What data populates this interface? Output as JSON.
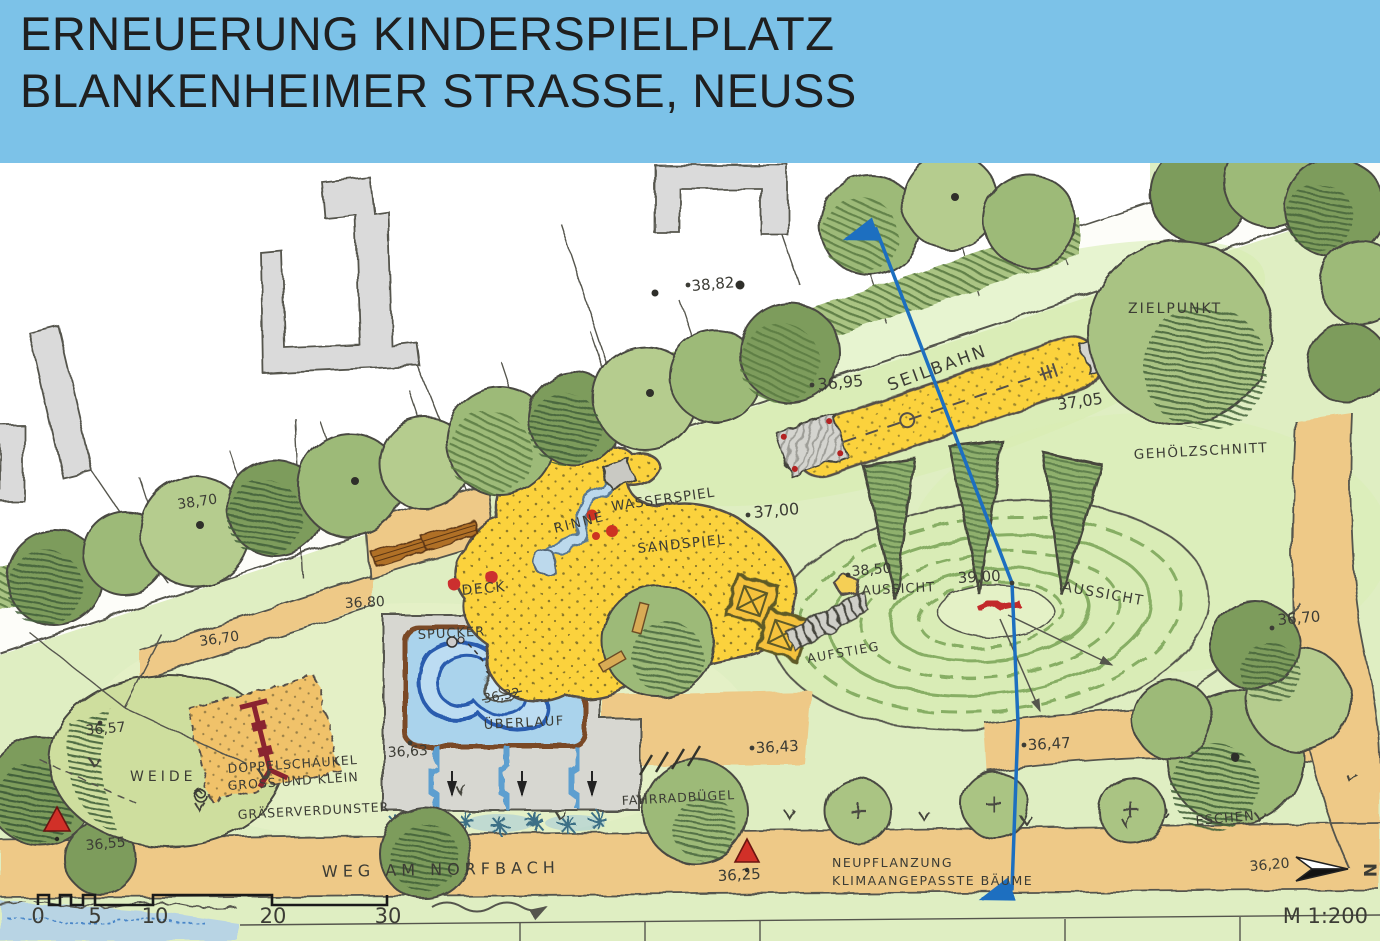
{
  "header": {
    "title_line1": "ERNEUERUNG KINDERSPIELPLATZ",
    "title_line2": "BLANKENHEIMER STRASSE, NEUSS"
  },
  "plan": {
    "labels": {
      "zielpunkt": "ZIELPUNKT",
      "seilbahn": "SEILBAHN",
      "gehoelzschnitt": "GEHÖLZSCHNITT",
      "wasserspiel": "WASSERSPIEL",
      "rinne": "RINNE",
      "sandspiel": "SANDSPIEL",
      "aussicht_west": "AUSSICHT",
      "aussicht_ost": "AUSSICHT",
      "aufstieg": "AUFSTIEG",
      "deck": "DECK",
      "spucker": "SPUCKER",
      "ueberlauf": "ÜBERLAUF",
      "weide": "WEIDE",
      "doppelschaukel_1": "DOPPELSCHAUKEL",
      "doppelschaukel_2": "GROSS UND KLEIN",
      "graeserverdunster": "GRÄSERVERDUNSTER",
      "fahrradbuegel": "FAHRRADBÜGEL",
      "weg_am_norfbach": "WEG  AM  NORFBACH",
      "neupflanzung_1": "NEUPFLANZUNG",
      "neupflanzung_2": "KLIMAANGEPASSTE  BÄUME",
      "eschen": "ESCHEN"
    },
    "elevations": {
      "p38_82": "38,82",
      "p38_70": "38,70",
      "p36_95": "36,95",
      "p37_05": "37,05",
      "p37_00": "37,00",
      "p38_50": "38,50",
      "p39_00": "39,00",
      "p36_70_ost": "36,70",
      "p36_80": "36,80",
      "p36_70_west": "36,70",
      "p36_32": "36,32",
      "p36_57": "36,57",
      "p36_63": "36,63",
      "p36_43": "36,43",
      "p36_47": "36,47",
      "p36_55": "36,55",
      "p36_25": "36,25",
      "p36_20": "36,20"
    },
    "scalebar": {
      "ticks": [
        "0",
        "5",
        "10",
        "20",
        "30"
      ],
      "scale_text": "M 1:200"
    },
    "north_label": "N",
    "colors": {
      "banner_blue": "#7cc2e8",
      "park_green": "#dfeec2",
      "path_tan": "#eec987",
      "play_sand_yellow": "#fbd23c",
      "water_blue": "#a9d2ec",
      "tree_green_dark": "#7d9c5b",
      "tree_green_mid": "#9dba78",
      "section_line_blue": "#1d6fc0",
      "marker_red": "#cc2f2f"
    }
  }
}
